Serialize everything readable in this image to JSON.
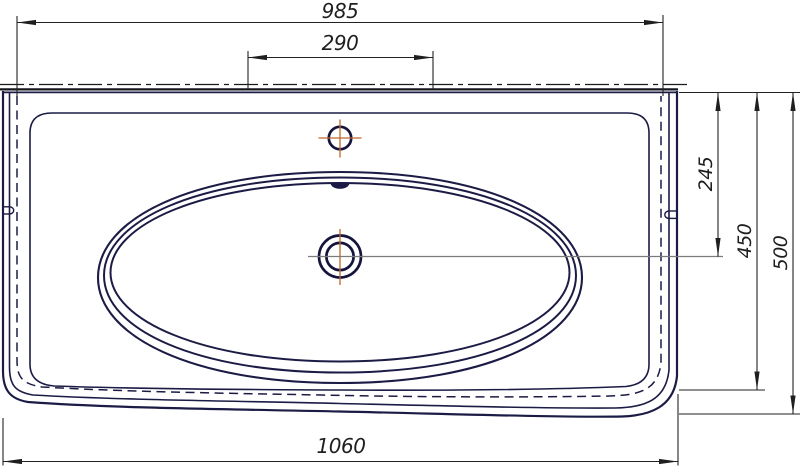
{
  "drawing": {
    "subject": "washbasin-top-view-technical-drawing"
  },
  "dimensions": {
    "top_edge_width": "985",
    "tap_hole_spacing": "290",
    "overall_width": "1060",
    "back_edge_to_drain": "245",
    "basin_depth": "450",
    "overall_depth": "500"
  },
  "colors": {
    "outline_navy": "#1b1b45",
    "dimension_black": "#1f1f1f",
    "centerline_orange": "#c0662c",
    "extension_gray": "#7b7b7b",
    "background": "#ffffff"
  }
}
